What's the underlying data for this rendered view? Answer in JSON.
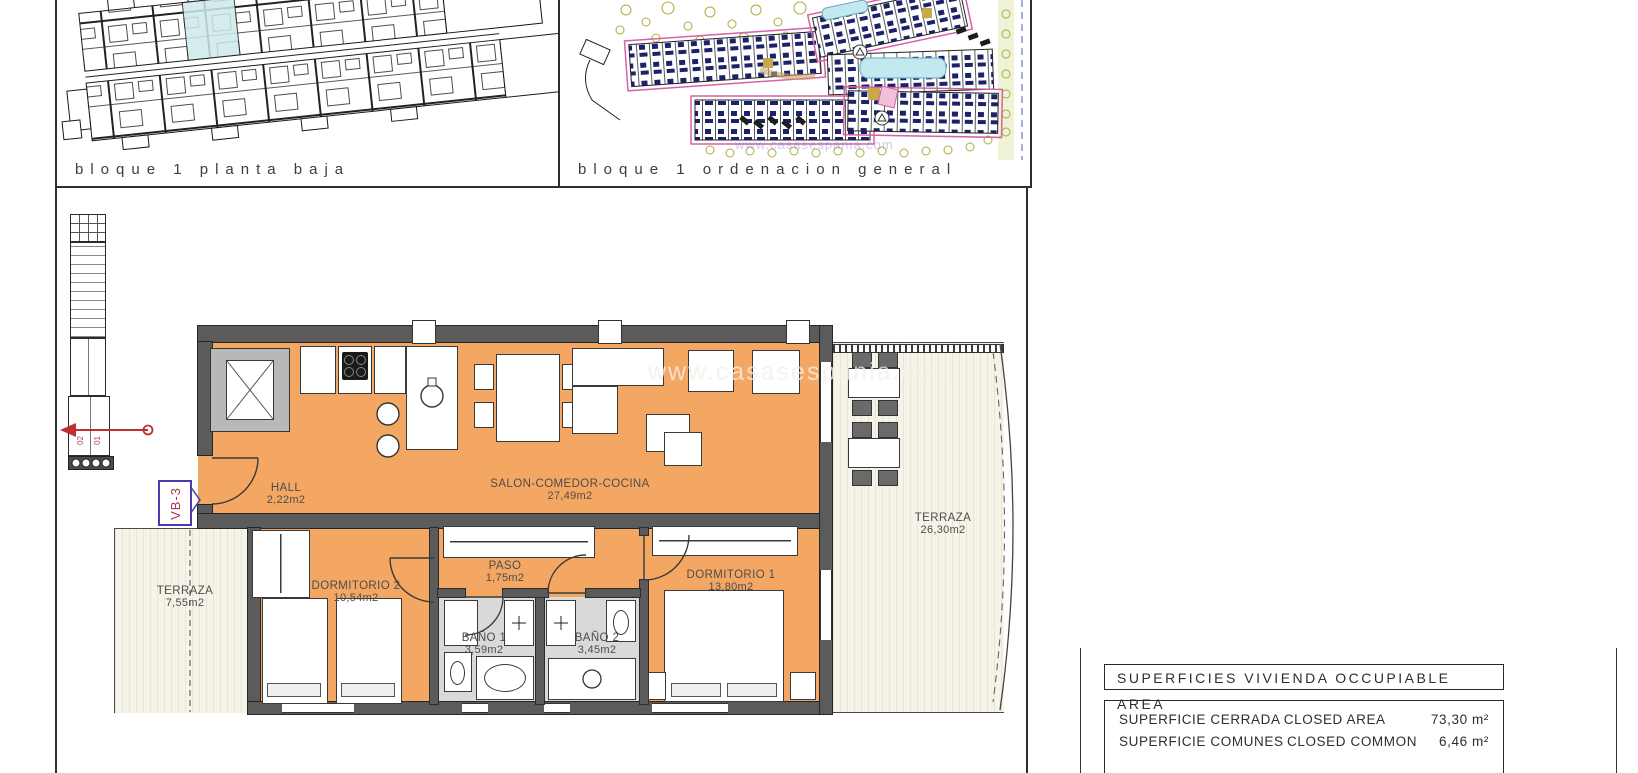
{
  "captions": {
    "left_panel": "bloque 1 planta baja",
    "right_panel": "bloque 1 ordenacion general"
  },
  "watermark": "www.casasespania.com",
  "plan": {
    "unit_tag": "VB-3",
    "stair_marks": [
      "02",
      "01"
    ],
    "rooms": {
      "hall": {
        "name": "HALL",
        "area": "2,22m2"
      },
      "salon": {
        "name": "SALON-COMEDOR-COCINA",
        "area": "27,49m2"
      },
      "paso": {
        "name": "PASO",
        "area": "1,75m2"
      },
      "dormitorio2": {
        "name": "DORMITORIO 2",
        "area": "10,54m2"
      },
      "dormitorio1": {
        "name": "DORMITORIO 1",
        "area": "13,80m2"
      },
      "bano1": {
        "name": "BAÑO 1",
        "area": "3,59m2"
      },
      "bano2": {
        "name": "BAÑO 2",
        "area": "3,45m2"
      },
      "terraza_left": {
        "name": "TERRAZA",
        "area": "7,55m2"
      },
      "terraza_right": {
        "name": "TERRAZA",
        "area": "26,30m2"
      }
    }
  },
  "areas_table": {
    "title": "SUPERFICIES VIVIENDA OCCUPIABLE AREA",
    "rows": [
      {
        "label_es": "SUPERFICIE CERRADA",
        "label_en": "CLOSED AREA",
        "value": "73,30 m²"
      },
      {
        "label_es": "SUPERFICIE COMUNES",
        "label_en": "CLOSED COMMON",
        "value": "6,46 m²"
      }
    ]
  },
  "colors": {
    "apartment_fill": "#F4A763",
    "terrace_fill": "#F6F3E8",
    "wall": "#5B5B5B",
    "accent_red": "#C03030",
    "accent_purple": "#4A3AB0",
    "site_navy": "#1C2268",
    "site_magenta": "#D860A8",
    "site_olive": "#B3A93F",
    "site_cyan": "#C2E9EF"
  }
}
